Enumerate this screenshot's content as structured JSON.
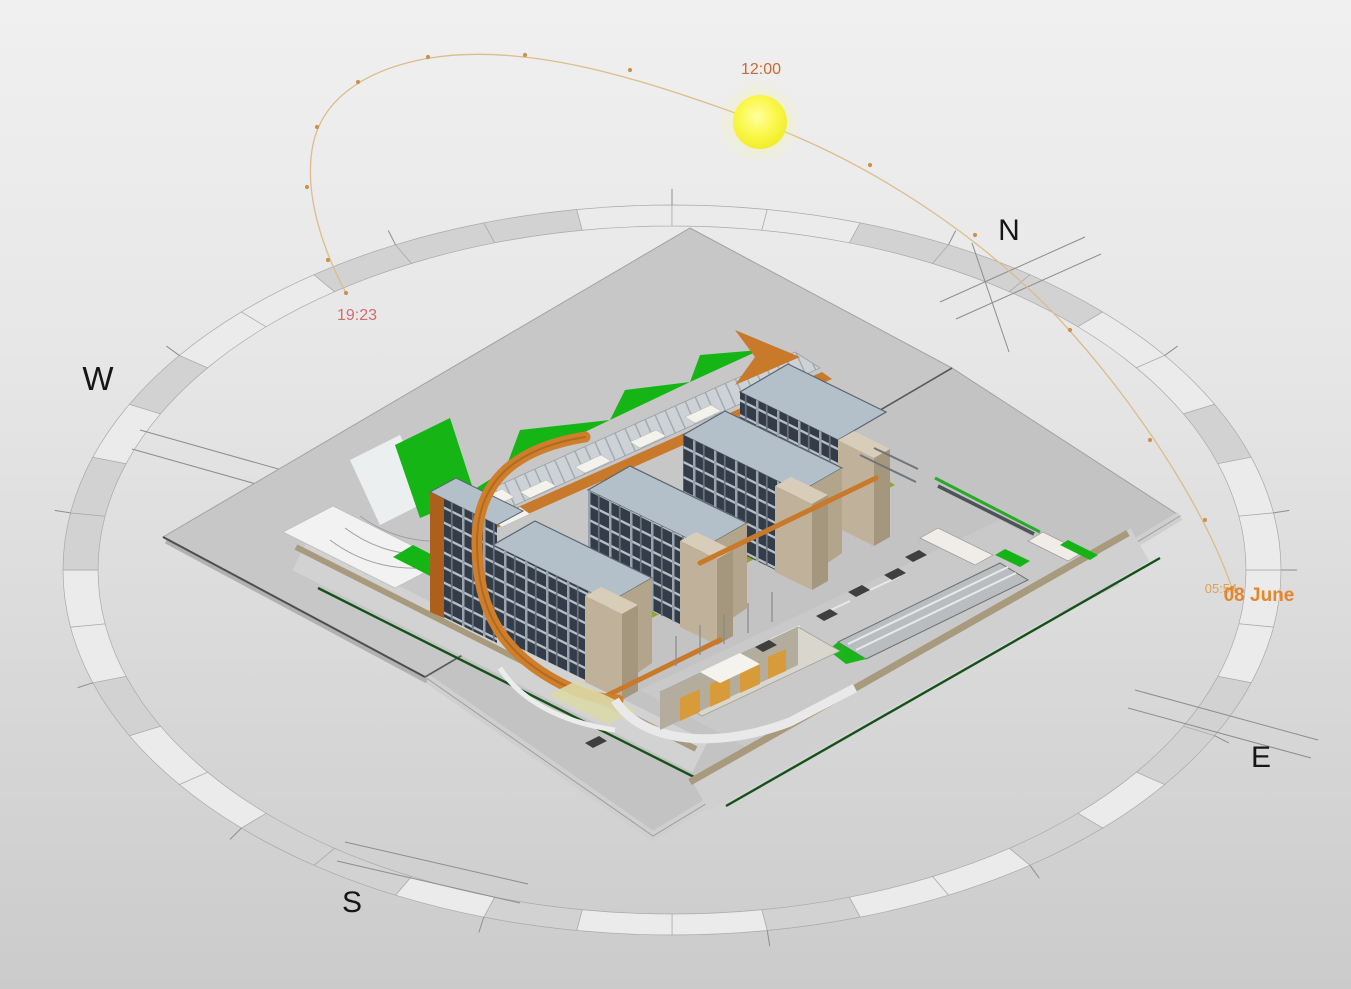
{
  "view": {
    "kind": "sun-path-study-3d-view",
    "width": 1351,
    "height": 989
  },
  "background": {
    "top": "#f0f0f0",
    "bottom": "#cbcbcb"
  },
  "compass": {
    "n": "N",
    "e": "E",
    "s": "S",
    "w": "W",
    "label_color": "#161616",
    "ring": {
      "cx": 672,
      "cy": 570,
      "outer_rx": 609,
      "outer_ry": 365,
      "inner_rx": 574,
      "inner_ry": 344,
      "segments": 40,
      "shades": [
        0,
        0,
        1,
        1,
        0,
        1,
        0,
        0,
        1,
        0,
        0,
        1,
        0,
        1,
        1,
        0,
        0,
        1,
        0,
        0,
        1,
        1,
        0,
        1,
        0,
        0,
        1,
        1,
        1,
        0,
        0,
        0,
        1,
        1,
        1,
        0,
        0,
        1,
        0,
        0
      ],
      "light": "#ebebeb",
      "dark": "#d2d2d2",
      "outline": "#a9a9a9",
      "tick_color": "#8f8f8f",
      "tick_len": 16,
      "tick_every": 3
    }
  },
  "sun": {
    "x": 760,
    "y": 122,
    "r": 27,
    "core": "#ffff8c",
    "mid": "#f8f545",
    "glow": "rgba(250,250,130,0.35)"
  },
  "sun_path": {
    "stroke": "#dcbc8a",
    "path": "M 346 293 C 322 248 305 195 312 150 C 319 103 360 70 430 58 C 530 42 645 80 760 122 C 876 165 985 240 1060 320 C 1140 407 1205 510 1232 588",
    "dots": [
      [
        346,
        293
      ],
      [
        328,
        260
      ],
      [
        307,
        187
      ],
      [
        317,
        127
      ],
      [
        358,
        82
      ],
      [
        428,
        57
      ],
      [
        525,
        55
      ],
      [
        630,
        70
      ],
      [
        870,
        165
      ],
      [
        975,
        235
      ],
      [
        1070,
        330
      ],
      [
        1150,
        440
      ],
      [
        1205,
        520
      ],
      [
        1232,
        588
      ]
    ],
    "dot_color": "#c9924e"
  },
  "labels": {
    "noon": {
      "text": "12:00",
      "color": "#c96a2e"
    },
    "sunset": {
      "text": "19:23",
      "color": "#d06d6d"
    },
    "sunrise": {
      "text": "05:54",
      "color": "#de9a46"
    },
    "date": {
      "text": "08 June",
      "color": "#e5862c"
    }
  },
  "model_palette": {
    "terrace_plane": "#c7c7c7",
    "site_plane": "#c3c3c3",
    "site_edge_dark": "#4e4e4e",
    "road_light": "#d2d2d2",
    "road_tan": "#a89a7c",
    "boundary_green": "#15521a",
    "lawn_green": "#14b514",
    "courtyard_olive": "#93a433",
    "facade_glazing": "#333d49",
    "facade_concrete": "#b7bfc7",
    "end_wall_tan": "#b3a48c",
    "roof_bluegray": "#b4c0c9",
    "ribbon_orange": "#c8792a",
    "ribbon_orange_dark": "#ad5f1c"
  }
}
